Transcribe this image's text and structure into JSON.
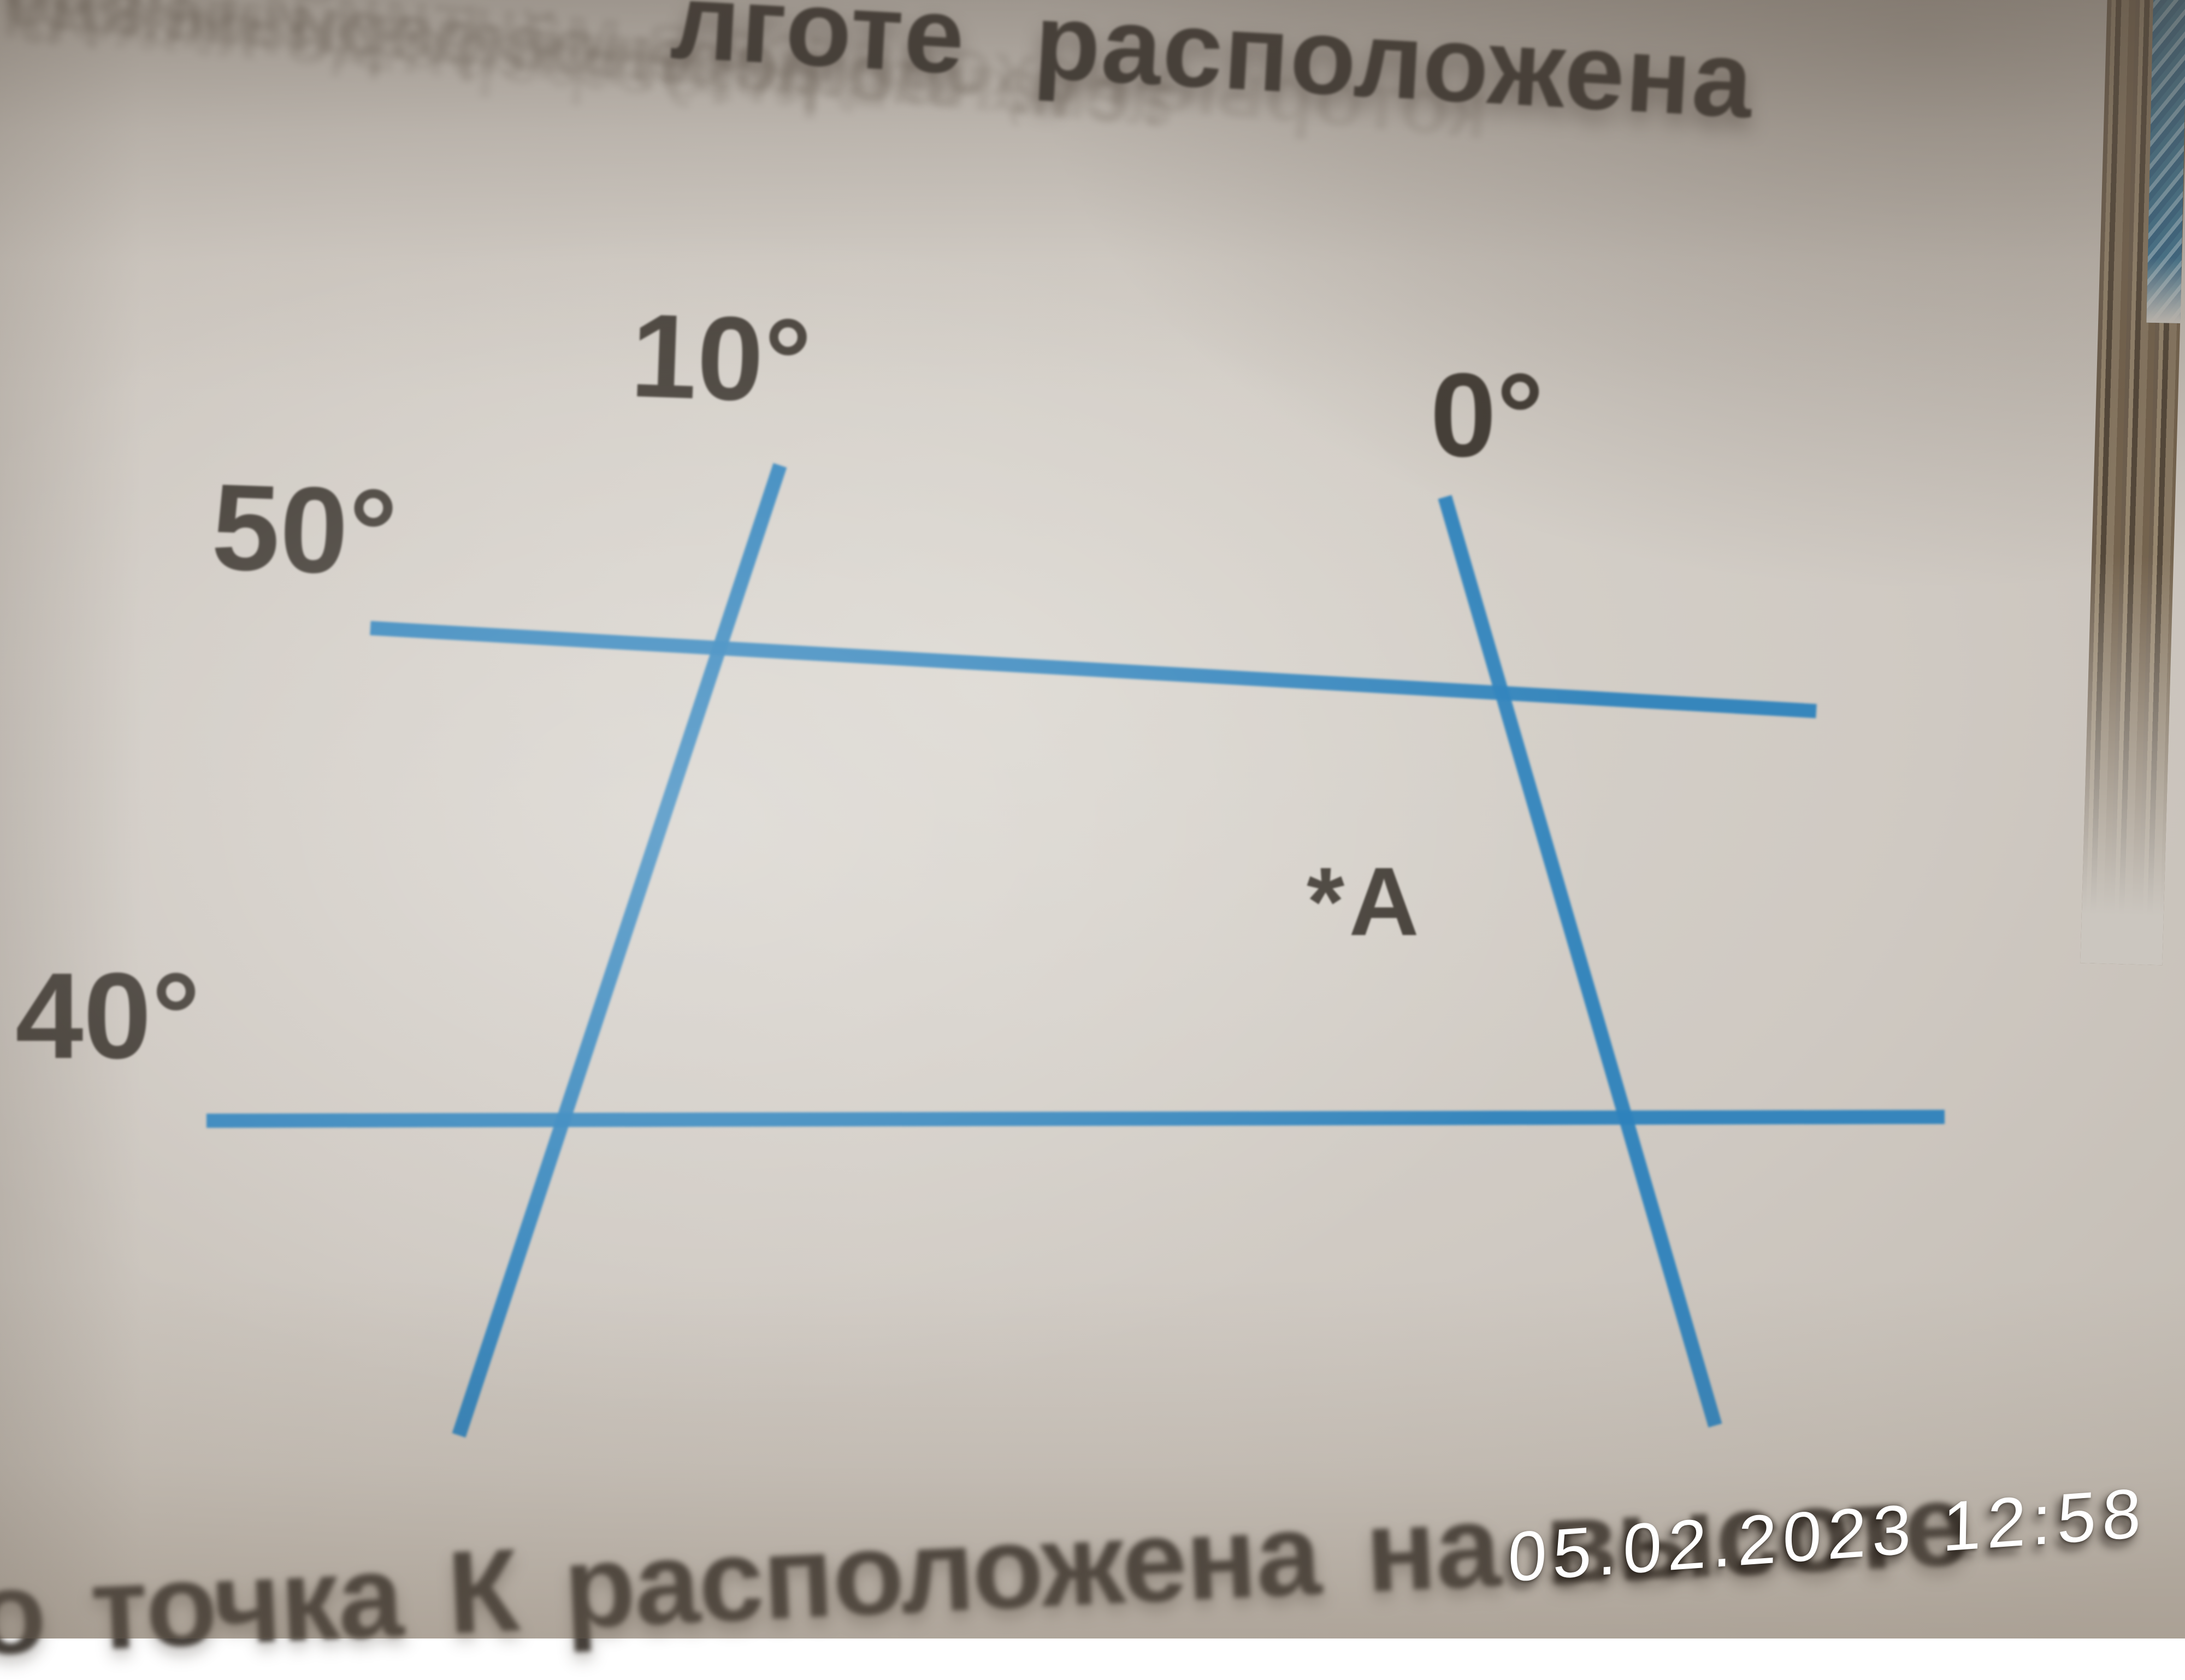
{
  "photo": {
    "top_heading_fragment": "лготе расположена",
    "bottom_heading_fragment": "о точка К расположена на высоте",
    "timestamp": "05.02.2023 12:58"
  },
  "diagram": {
    "type": "geographic-coordinate-grid",
    "line_color": "#2e82bc",
    "meridians": [
      {
        "label": "10°"
      },
      {
        "label": "0°"
      }
    ],
    "parallels": [
      {
        "label": "50°"
      },
      {
        "label": "40°"
      }
    ],
    "point": {
      "name": "A",
      "label": "*A"
    }
  },
  "bleed_through_fragments": [
    "Литосферные плиты",
    "астеносферный слой между",
    "тем, что астеносферный сло",
    "которые находятся в мантии и спосо",
    "в результате движения",
    "их столкновения возникают"
  ]
}
